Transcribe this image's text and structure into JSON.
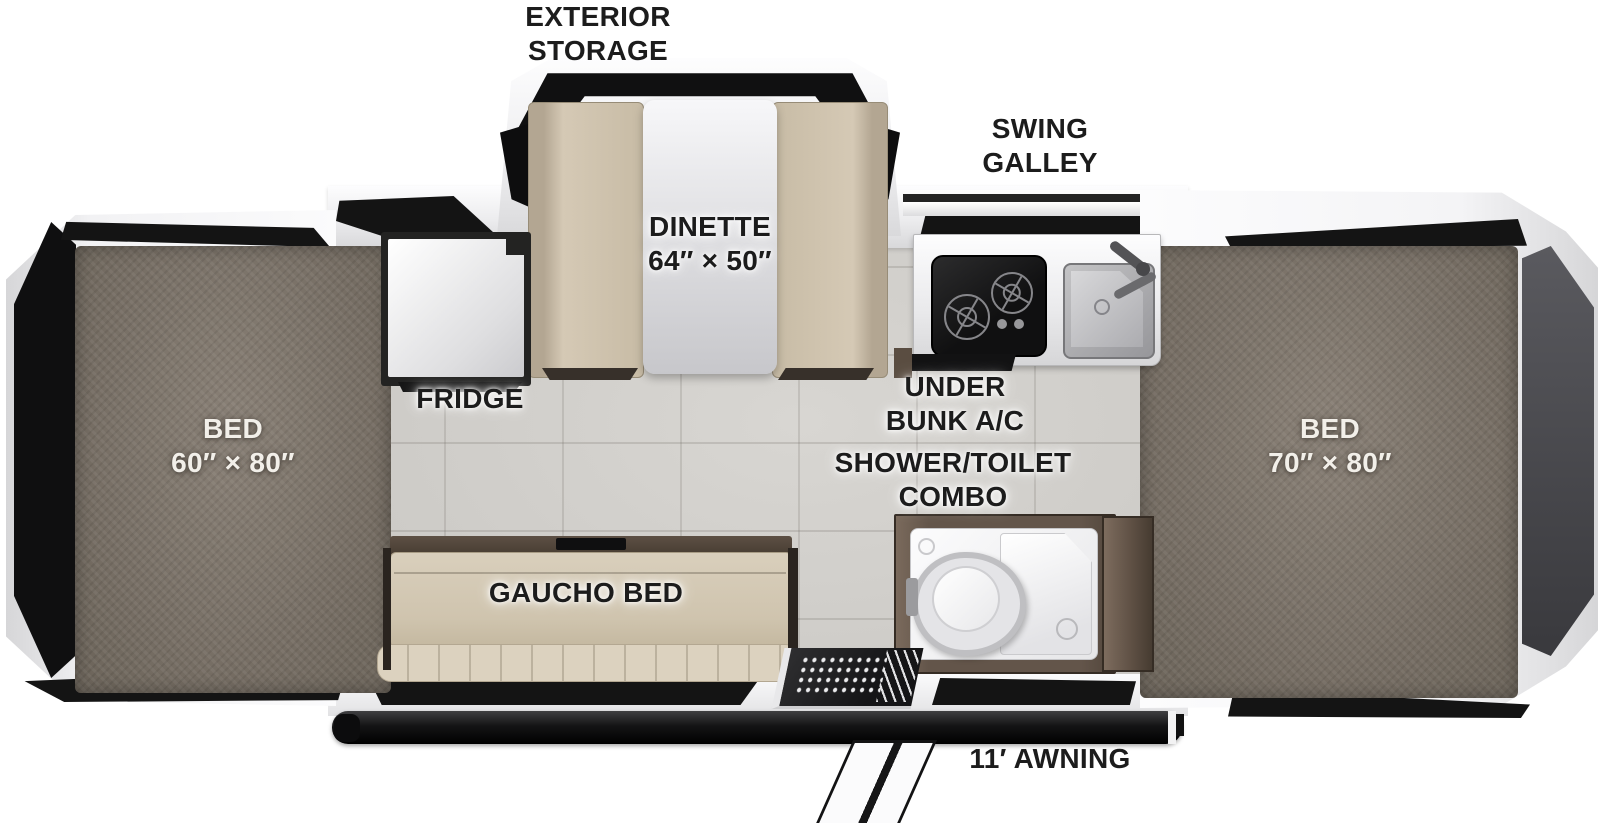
{
  "diagram": {
    "type": "rv-popup-camper-floorplan-top-view",
    "labels": {
      "exterior_storage": {
        "line1": "EXTERIOR",
        "line2": "STORAGE"
      },
      "swing_galley": {
        "line1": "SWING",
        "line2": "GALLEY"
      },
      "dinette": {
        "name": "DINETTE",
        "size": "64″ × 50″"
      },
      "fridge": {
        "name": "FRIDGE"
      },
      "under_bunk_ac": {
        "line1": "UNDER",
        "line2": "BUNK A/C"
      },
      "shower_toilet": {
        "line1": "SHOWER/TOILET",
        "line2": "COMBO"
      },
      "bed_left": {
        "name": "BED",
        "size": "60″ × 80″"
      },
      "bed_right": {
        "name": "BED",
        "size": "70″ × 80″"
      },
      "gaucho_bed": {
        "name": "GAUCHO BED"
      },
      "awning": {
        "name": "11′ AWNING"
      }
    },
    "colors": {
      "label_text": "#1c1c1c",
      "bed_label_text": "#f2efe9",
      "mattress": "#7f776c",
      "cushion": "#d5c9b5",
      "floor": "#d2d0cc",
      "panel_black": "#141414",
      "wood_brown": "#6b5c4f",
      "frame_white": "#f6f6f7",
      "steel_gray": "#b3b4b6",
      "awning_rail": "#1b1b1b"
    }
  }
}
